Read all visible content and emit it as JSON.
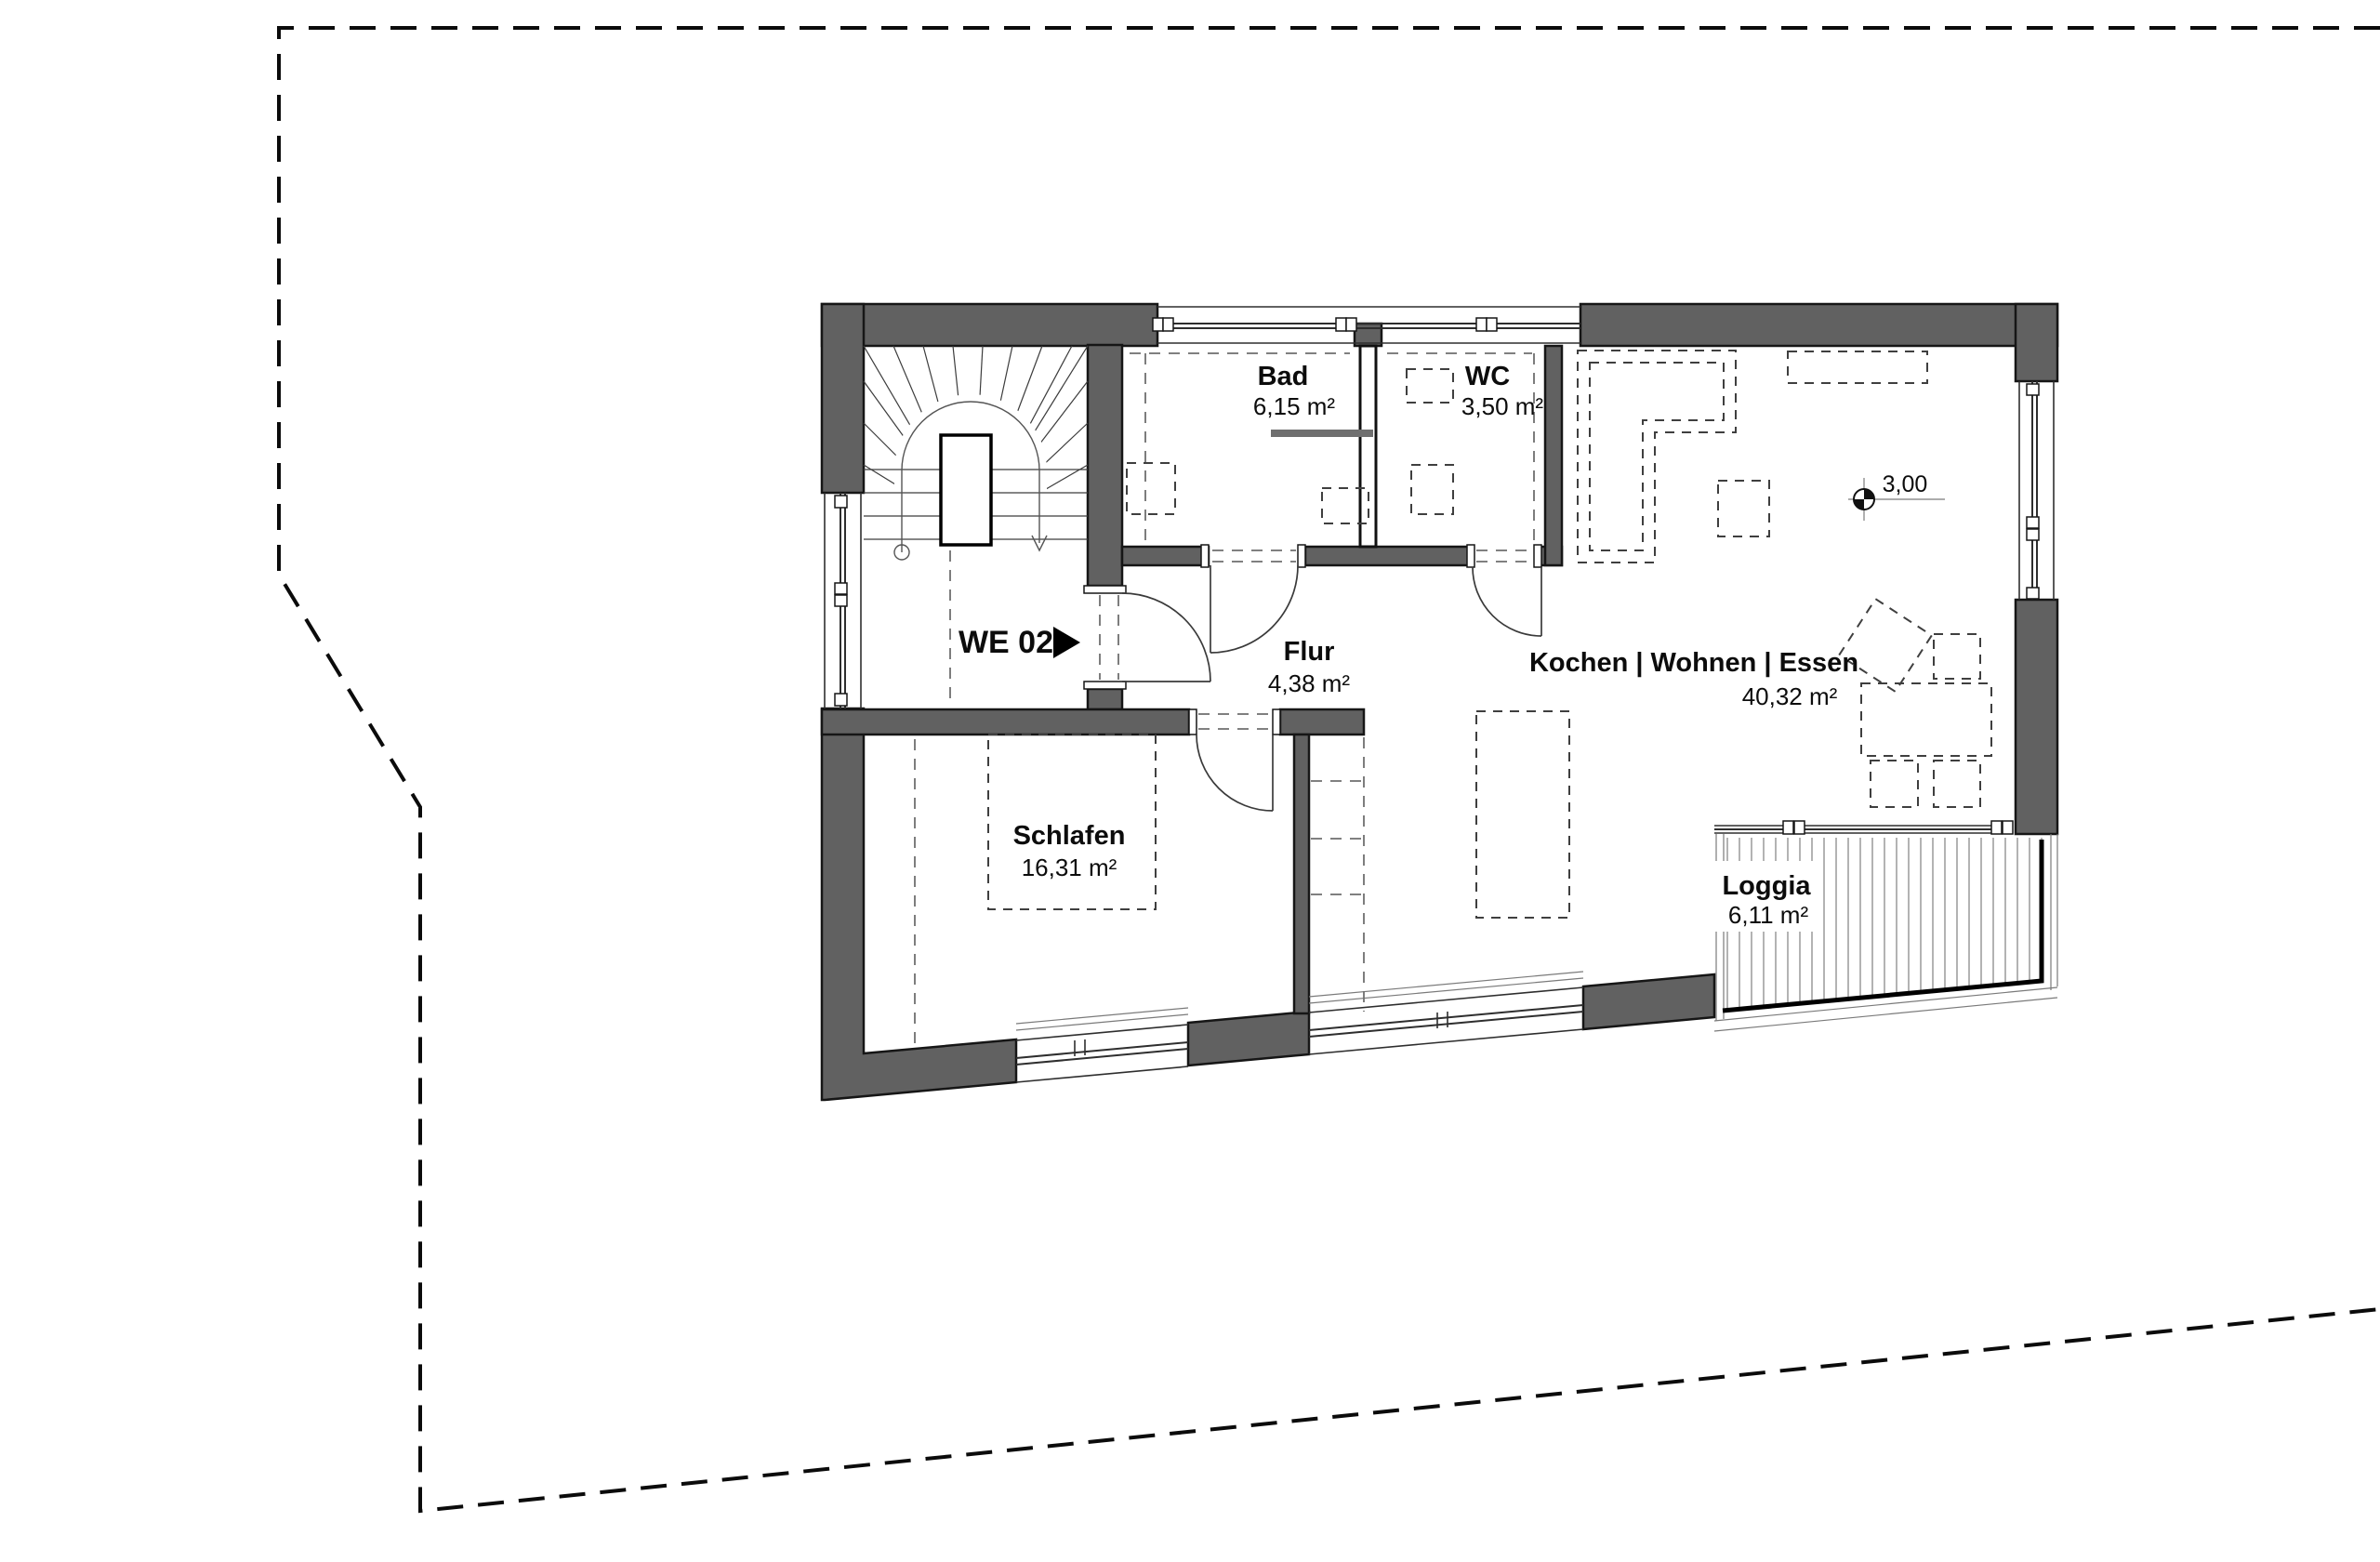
{
  "unit": {
    "label": "WE 02"
  },
  "level_marker": {
    "value": "3,00"
  },
  "rooms": [
    {
      "id": "bad",
      "name": "Bad",
      "area": "6,15 m²"
    },
    {
      "id": "wc",
      "name": "WC",
      "area": "3,50 m²"
    },
    {
      "id": "wohnen",
      "name": "Kochen | Wohnen | Essen",
      "area": "40,32 m²"
    },
    {
      "id": "flur",
      "name": "Flur",
      "area": "4,38 m²"
    },
    {
      "id": "schlafen",
      "name": "Schlafen",
      "area": "16,31 m²"
    },
    {
      "id": "loggia",
      "name": "Loggia",
      "area": "6,11 m²"
    }
  ],
  "colors": {
    "wall": "#616161",
    "line": "#1a1a1a",
    "background": "#ffffff"
  }
}
